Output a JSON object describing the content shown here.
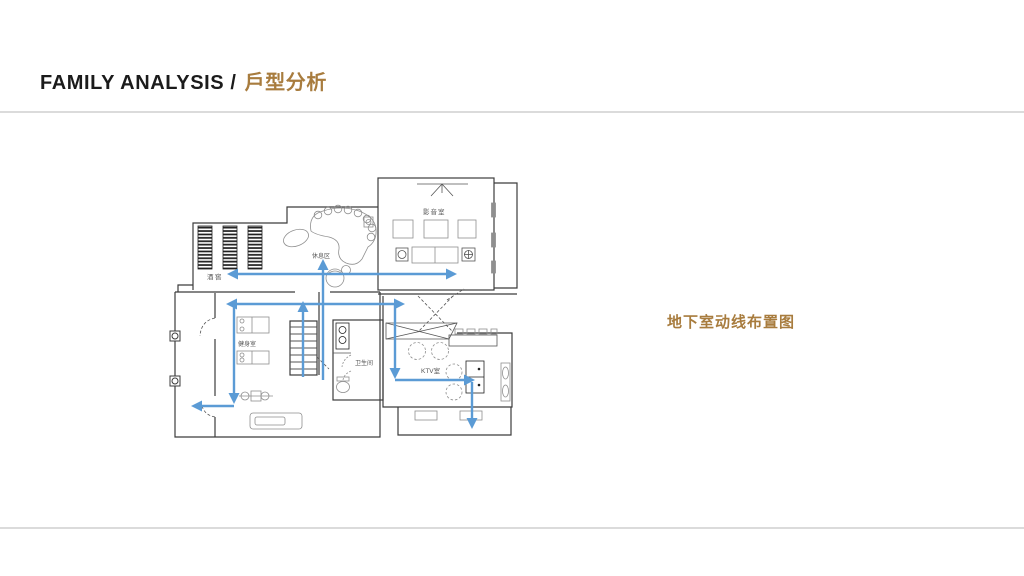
{
  "header": {
    "title_en": "FAMILY ANALYSIS /",
    "title_zh": "戶型分析"
  },
  "caption": {
    "text": "地下室动线布置图"
  },
  "plan": {
    "rooms": [
      {
        "id": "wine-cellar",
        "label": "酒窖"
      },
      {
        "id": "lounge",
        "label": "休息区"
      },
      {
        "id": "home-theater",
        "label": "影音室"
      },
      {
        "id": "gym",
        "label": "健身室"
      },
      {
        "id": "bathroom",
        "label": "卫生间"
      },
      {
        "id": "ktv",
        "label": "KTV室"
      }
    ]
  },
  "colors": {
    "accent_brown": "#A87C3E",
    "arrow_blue": "#5B9BD5",
    "divider_gray": "#DBDBDB",
    "wall_dark": "#3C3C3C",
    "furniture_gray": "#8F8F8F"
  }
}
